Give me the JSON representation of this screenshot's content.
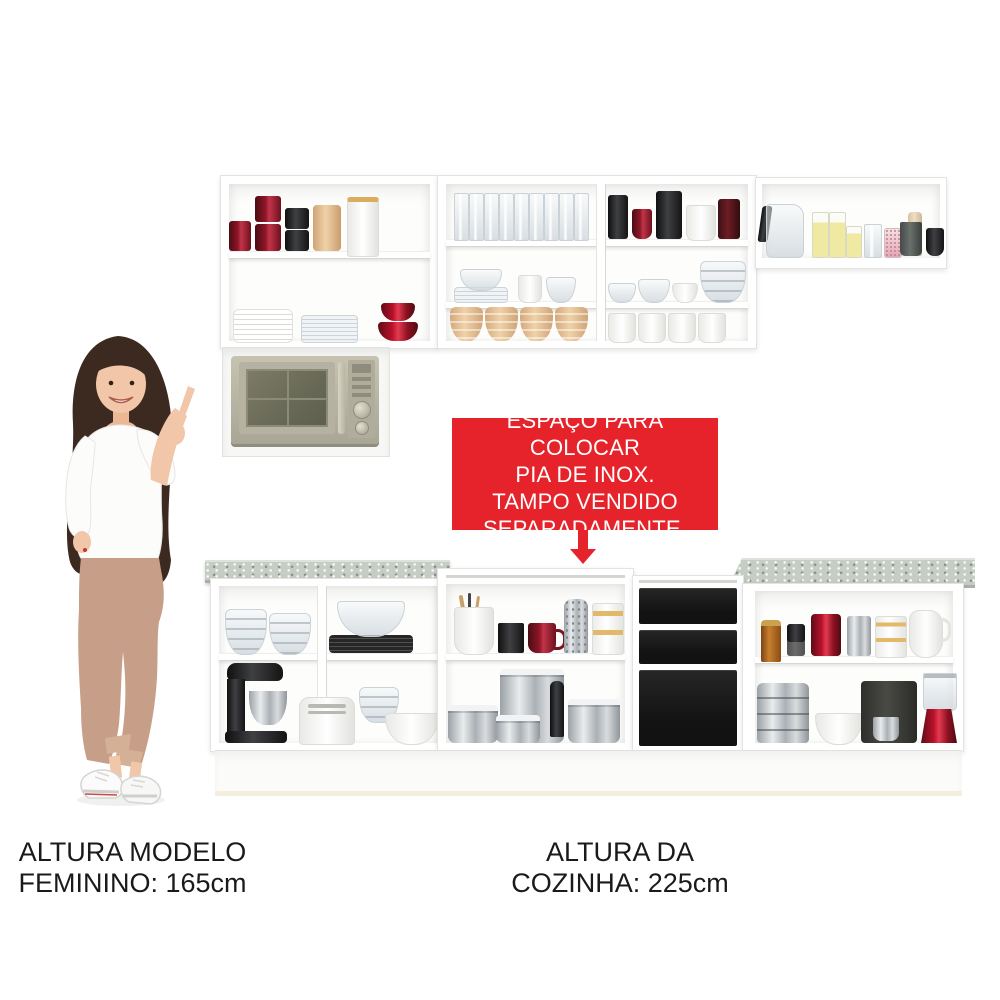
{
  "palette": {
    "bg": "#ffffff",
    "red": "#e6232a",
    "text": "#1a1a1a",
    "cabinet": "#ffffff",
    "cabinet-edge": "#e3e3df",
    "countertop": "#c6cdc4",
    "drawer-black": "#1b1b1b",
    "hair": "#3c2a21",
    "skin": "#f1c6a9",
    "pants": "#c79f89",
    "microwave-body": "#b7b4a3"
  },
  "annotation": {
    "lines": [
      "ESPAÇO PARA COLOCAR",
      "PIA DE INOX.",
      "TAMPO VENDIDO",
      "SEPARADAMENTE."
    ]
  },
  "captions": {
    "model": {
      "line1": "ALTURA MODELO",
      "line2": "FEMININO: 165cm"
    },
    "kitchen": {
      "line1": "ALTURA DA",
      "line2": "COZINHA: 225cm"
    }
  },
  "scene": {
    "description": "Kitchen cabinet set product photo with female model pointing at upper cabinets",
    "model": "woman with long dark hair, white blouse, tan trousers, white sneakers, pointing up at cabinets",
    "upper_cabinets": {
      "left": {
        "top_shelf": [
          "red canister",
          "stacked red canisters",
          "stacked black canisters",
          "tan canister",
          "white jar with gold trim"
        ],
        "bottom": [
          "white plate stack",
          "glass plate stack",
          "red glass bowls"
        ]
      },
      "middle_left": {
        "top": [
          "drinking glasses"
        ],
        "middle": [
          "glass plates and bowls",
          "white cups"
        ],
        "bottom": [
          "beige bowls"
        ]
      },
      "middle_right": {
        "top": [
          "dark tumblers",
          "red mug",
          "black cylinder",
          "white mug",
          "dark red box"
        ],
        "middle": [
          "glass bowls",
          "white bowl"
        ],
        "bottom": [
          "white cups"
        ]
      },
      "right_shelf": [
        "glass kettle",
        "yellow glasses",
        "clear glass",
        "pink jar",
        "beige candle",
        "gray cup",
        "black cup"
      ],
      "appliance": "microwave oven"
    },
    "lower_cabinets": {
      "left": {
        "top": [
          "glass bowl stacks",
          "large glass bowl",
          "black plate stack"
        ],
        "bottom": [
          "black stand mixer",
          "white toaster",
          "glass bowls",
          "white bowl"
        ]
      },
      "sink_space": {
        "top": [
          "utensil pot",
          "black box",
          "red mug",
          "metal grater",
          "white canister"
        ],
        "bottom": [
          "stainless pots",
          "pepper mill"
        ]
      },
      "drawers": [
        "black drawer",
        "black drawer",
        "black door"
      ],
      "right": {
        "top": [
          "amber bottle",
          "dark bottle",
          "red canister",
          "silver canister",
          "white canister with gold trim",
          "white pitcher"
        ],
        "bottom": [
          "stainless steamer stack",
          "white bowl",
          "coffee machine",
          "red blender"
        ]
      }
    }
  }
}
